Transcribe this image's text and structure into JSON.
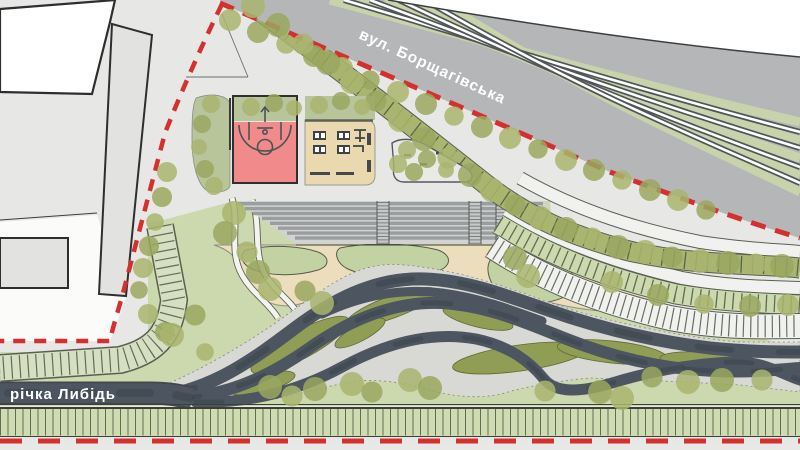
{
  "title": "landscape masterplan — Lybid river park site plan",
  "labels": {
    "street": "вул. Борщагівська",
    "river": "річка Либідь"
  },
  "legend": {
    "boundary": "red dashed site boundary",
    "street_icon": "tram-tracks",
    "water_icon": "braided-channels"
  },
  "palette": {
    "ground": "#e7e7e5",
    "white": "#ffffff",
    "outline": "#2e2e2e",
    "bldgGray": "#e2e2e1",
    "street": "#b4b6b8",
    "railDark": "#515557",
    "railWhite": "#ffffff",
    "trackGrass": "#c9d3ab",
    "red": "#d43030",
    "park": "#ccd8ad",
    "lawn": "#c3d2a2",
    "lawnLine": "#565b4c",
    "olive": "#8f9d55",
    "oliveLine": "#60682f",
    "water": "#4d5660",
    "waterDeep": "#39414a",
    "zone": "#d8d8d4",
    "zoneLine": "#85867e",
    "beige": "#ecdebc",
    "beigeLine": "#8e8f85",
    "pad": "#ead9ae",
    "padGreen": "#b8c49a",
    "court": "#f18a8a",
    "courtLine": "#4b5257",
    "steps": "#9b9ea0",
    "stepsLight": "#d2d3d0",
    "flight": "#c7c9c6",
    "stripWhite": "#f1f1ef",
    "stripGreen": "#ccd8ae",
    "tickDark": "#45503c",
    "bottomGreen": "#cfdcb2",
    "grayStrip": "#e8e8e6",
    "tree1": "#a9b56e",
    "tree2": "#9aa75f",
    "label": "#ffffff",
    "dimLine": "#6b6e71"
  },
  "trees": {
    "groups": [
      {
        "name": "street-trees",
        "r": 11,
        "points": [
          [
            230,
            20
          ],
          [
            258,
            32
          ],
          [
            286,
            44
          ],
          [
            314,
            56
          ],
          [
            342,
            68
          ],
          [
            370,
            80
          ],
          [
            398,
            92
          ],
          [
            426,
            104
          ],
          [
            454,
            116
          ],
          [
            482,
            127
          ],
          [
            510,
            138
          ],
          [
            538,
            149
          ],
          [
            566,
            160
          ],
          [
            594,
            170
          ],
          [
            622,
            180
          ],
          [
            650,
            190
          ],
          [
            678,
            200
          ],
          [
            706,
            210
          ]
        ]
      },
      {
        "name": "promenade-trees",
        "r": 12,
        "points": [
          [
            253,
            6
          ],
          [
            278,
            25
          ],
          [
            303,
            44
          ],
          [
            328,
            63
          ],
          [
            352,
            82
          ],
          [
            376,
            101
          ],
          [
            400,
            120
          ],
          [
            424,
            139
          ],
          [
            448,
            158
          ],
          [
            470,
            175
          ],
          [
            492,
            190
          ],
          [
            515,
            205
          ],
          [
            540,
            218
          ],
          [
            566,
            229
          ],
          [
            592,
            238
          ],
          [
            618,
            247
          ],
          [
            645,
            252
          ],
          [
            672,
            257
          ],
          [
            700,
            261
          ],
          [
            728,
            263
          ],
          [
            756,
            264
          ],
          [
            782,
            266
          ]
        ]
      },
      {
        "name": "row2-trees",
        "r": 11,
        "points": [
          [
            612,
            282
          ],
          [
            658,
            295
          ],
          [
            704,
            304
          ],
          [
            750,
            306
          ],
          [
            788,
            305
          ]
        ]
      },
      {
        "name": "left-boundary-trees",
        "r": 10,
        "points": [
          [
            167,
            172
          ],
          [
            162,
            197
          ],
          [
            155,
            222
          ],
          [
            149,
            246
          ],
          [
            143,
            268
          ],
          [
            139,
            290
          ],
          [
            148,
            314
          ],
          [
            165,
            332
          ],
          [
            205,
            352
          ]
        ]
      },
      {
        "name": "sports-blob-trees",
        "r": 9,
        "points": [
          [
            211,
            104
          ],
          [
            202,
            124
          ],
          [
            199,
            147
          ],
          [
            205,
            169
          ],
          [
            214,
            186
          ]
        ]
      },
      {
        "name": "court-top-trees",
        "r": 9,
        "points": [
          [
            251,
            107
          ],
          [
            274,
            103
          ],
          [
            294,
            108
          ]
        ]
      },
      {
        "name": "pad-top-trees",
        "r": 9,
        "points": [
          [
            319,
            105
          ],
          [
            341,
            101
          ],
          [
            362,
            107
          ]
        ]
      },
      {
        "name": "triangle-trees",
        "r": 9,
        "points": [
          [
            407,
            150
          ],
          [
            427,
            159
          ],
          [
            446,
            170
          ],
          [
            414,
            172
          ],
          [
            398,
            164
          ]
        ]
      },
      {
        "name": "park-trees",
        "r": 12,
        "points": [
          [
            234,
            213
          ],
          [
            225,
            233
          ],
          [
            247,
            252
          ],
          [
            258,
            272
          ],
          [
            270,
            289
          ],
          [
            305,
            291
          ],
          [
            322,
            303
          ],
          [
            270,
            387
          ],
          [
            292,
            396
          ],
          [
            315,
            389
          ],
          [
            352,
            384
          ],
          [
            372,
            392
          ],
          [
            410,
            380
          ],
          [
            430,
            388
          ],
          [
            545,
            391
          ],
          [
            600,
            392
          ],
          [
            622,
            398
          ],
          [
            652,
            377
          ],
          [
            688,
            382
          ],
          [
            722,
            380
          ],
          [
            762,
            380
          ],
          [
            515,
            258
          ],
          [
            528,
            276
          ],
          [
            195,
            315
          ],
          [
            172,
            335
          ]
        ]
      }
    ]
  }
}
